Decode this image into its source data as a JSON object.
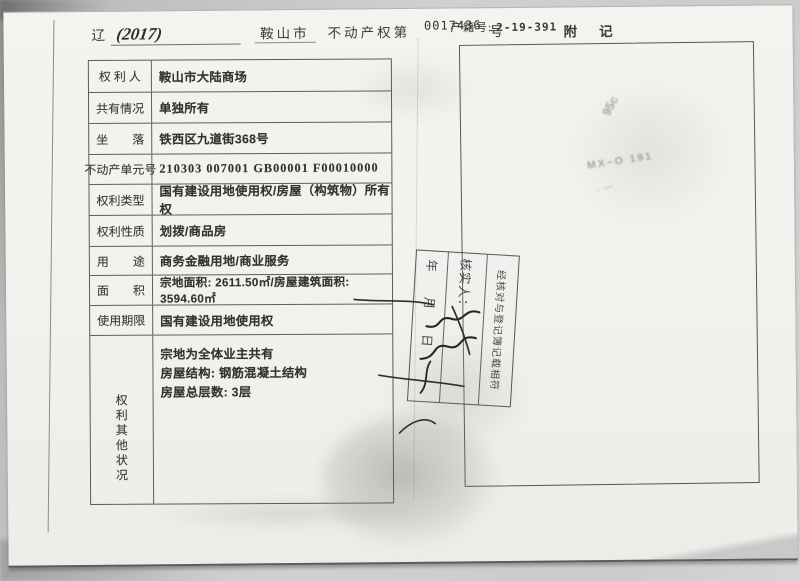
{
  "header": {
    "series_prefix": "辽",
    "year": "(2017)",
    "city": "鞍山市",
    "cert_text": "不动产权第",
    "cert_number": "0017436",
    "cert_suffix": "号",
    "property_id_label": "产籍号:",
    "property_id_value": "2-19-391",
    "notes_title": "附记"
  },
  "table": {
    "rows": [
      {
        "label": "权 利 人",
        "value": "鞍山市大陆商场"
      },
      {
        "label": "共有情况",
        "value": "单独所有"
      },
      {
        "label": "坐　　落",
        "value": "铁西区九道街368号"
      },
      {
        "label": "不动产单元号",
        "value": "210303 007001 GB00001 F00010000"
      },
      {
        "label": "权利类型",
        "value": "国有建设用地使用权/房屋（构筑物）所有权"
      },
      {
        "label": "权利性质",
        "value": "划拨/商品房"
      },
      {
        "label": "用　　途",
        "value": "商务金融用地/商业服务"
      },
      {
        "label": "面　　积",
        "value": "宗地面积: 2611.50㎡/房屋建筑面积: 3594.60㎡"
      },
      {
        "label": "使用期限",
        "value": "国有建设用地使用权"
      },
      {
        "label": "权利其他状况",
        "lines": [
          "宗地为全体业主共有",
          "房屋结构: 钢筋混凝土结构",
          "房屋总层数: 3层"
        ]
      }
    ]
  },
  "stamp": {
    "line1": "经核对与登记簿记载相符",
    "verifier_label": "核实人：",
    "date_line": "年　　月　　日"
  },
  "ghost_marks": {
    "mark1": "95c",
    "mark2": "MX~O 191",
    "mark3": "· —"
  },
  "colors": {
    "paper": "#f2f1ed",
    "ink": "#34322e",
    "table_line": "#5a5a5a",
    "stamp_ink": "#3e3c3a",
    "scanner_bg": "#c6c6c6"
  }
}
